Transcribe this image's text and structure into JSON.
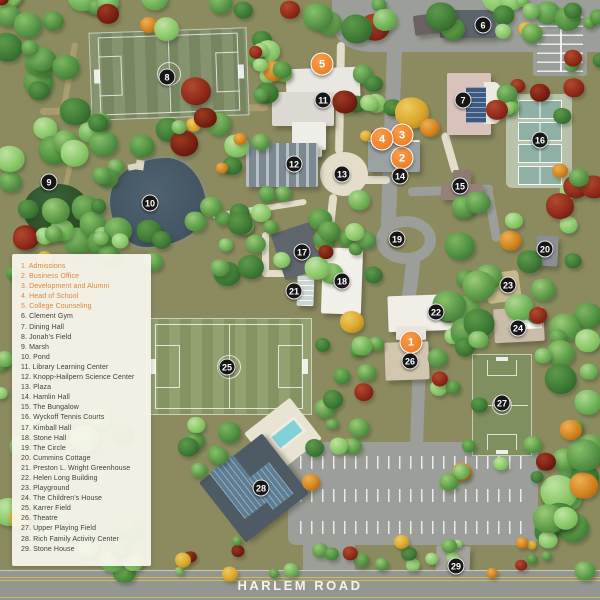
{
  "legend": {
    "items": [
      {
        "num": "1",
        "label": "Admissions",
        "highlighted": true
      },
      {
        "num": "2",
        "label": "Business Office",
        "highlighted": true
      },
      {
        "num": "3",
        "label": "Development and Alumni",
        "highlighted": true
      },
      {
        "num": "4",
        "label": "Head of School",
        "highlighted": true
      },
      {
        "num": "5",
        "label": "College Counseling",
        "highlighted": true
      },
      {
        "num": "6",
        "label": "Clement Gym",
        "highlighted": false
      },
      {
        "num": "7",
        "label": "Dining Hall",
        "highlighted": false
      },
      {
        "num": "8",
        "label": "Jonah's Field",
        "highlighted": false
      },
      {
        "num": "9",
        "label": "Marsh",
        "highlighted": false
      },
      {
        "num": "10",
        "label": "Pond",
        "highlighted": false
      },
      {
        "num": "11",
        "label": "Library Learning Center",
        "highlighted": false
      },
      {
        "num": "12",
        "label": "Knopp-Hailpern Science Center",
        "highlighted": false
      },
      {
        "num": "13",
        "label": "Plaza",
        "highlighted": false
      },
      {
        "num": "14",
        "label": "Hamlin Hall",
        "highlighted": false
      },
      {
        "num": "15",
        "label": "The Bungalow",
        "highlighted": false
      },
      {
        "num": "16",
        "label": "Wyckoff Tennis Courts",
        "highlighted": false
      },
      {
        "num": "17",
        "label": "Kimball Hall",
        "highlighted": false
      },
      {
        "num": "18",
        "label": "Stone Hall",
        "highlighted": false
      },
      {
        "num": "19",
        "label": "The Circle",
        "highlighted": false
      },
      {
        "num": "20",
        "label": "Cummins Cottage",
        "highlighted": false
      },
      {
        "num": "21",
        "label": "Preston L. Wright Greenhouse",
        "highlighted": false
      },
      {
        "num": "22",
        "label": "Helen Long Building",
        "highlighted": false
      },
      {
        "num": "23",
        "label": "Playground",
        "highlighted": false
      },
      {
        "num": "24",
        "label": "The Children's House",
        "highlighted": false
      },
      {
        "num": "25",
        "label": "Karrer Field",
        "highlighted": false
      },
      {
        "num": "26",
        "label": "Theatre",
        "highlighted": false
      },
      {
        "num": "27",
        "label": "Upper Playing Field",
        "highlighted": false
      },
      {
        "num": "28",
        "label": "Rich Family Activity Center",
        "highlighted": false
      },
      {
        "num": "29",
        "label": "Stone House",
        "highlighted": false
      }
    ]
  },
  "road": {
    "label": "HARLEM ROAD"
  },
  "map": {
    "markers": [
      {
        "num": "1",
        "x": 411,
        "y": 342,
        "type": "primary"
      },
      {
        "num": "2",
        "x": 402,
        "y": 158,
        "type": "primary"
      },
      {
        "num": "3",
        "x": 402,
        "y": 135,
        "type": "primary"
      },
      {
        "num": "4",
        "x": 382,
        "y": 139,
        "type": "primary"
      },
      {
        "num": "5",
        "x": 322,
        "y": 64,
        "type": "primary"
      },
      {
        "num": "6",
        "x": 483,
        "y": 25,
        "type": "secondary"
      },
      {
        "num": "7",
        "x": 463,
        "y": 100,
        "type": "secondary"
      },
      {
        "num": "8",
        "x": 167,
        "y": 77,
        "type": "secondary"
      },
      {
        "num": "9",
        "x": 49,
        "y": 182,
        "type": "secondary"
      },
      {
        "num": "10",
        "x": 150,
        "y": 203,
        "type": "secondary"
      },
      {
        "num": "11",
        "x": 323,
        "y": 100,
        "type": "secondary"
      },
      {
        "num": "12",
        "x": 294,
        "y": 164,
        "type": "secondary"
      },
      {
        "num": "13",
        "x": 342,
        "y": 174,
        "type": "secondary"
      },
      {
        "num": "14",
        "x": 400,
        "y": 176,
        "type": "secondary"
      },
      {
        "num": "15",
        "x": 460,
        "y": 186,
        "type": "secondary"
      },
      {
        "num": "16",
        "x": 540,
        "y": 140,
        "type": "secondary"
      },
      {
        "num": "17",
        "x": 302,
        "y": 252,
        "type": "secondary"
      },
      {
        "num": "18",
        "x": 342,
        "y": 281,
        "type": "secondary"
      },
      {
        "num": "19",
        "x": 397,
        "y": 239,
        "type": "secondary"
      },
      {
        "num": "20",
        "x": 545,
        "y": 249,
        "type": "secondary"
      },
      {
        "num": "21",
        "x": 294,
        "y": 291,
        "type": "secondary"
      },
      {
        "num": "22",
        "x": 436,
        "y": 312,
        "type": "secondary"
      },
      {
        "num": "23",
        "x": 508,
        "y": 285,
        "type": "secondary"
      },
      {
        "num": "24",
        "x": 518,
        "y": 328,
        "type": "secondary"
      },
      {
        "num": "25",
        "x": 227,
        "y": 367,
        "type": "secondary"
      },
      {
        "num": "26",
        "x": 410,
        "y": 361,
        "type": "secondary"
      },
      {
        "num": "27",
        "x": 502,
        "y": 403,
        "type": "secondary"
      },
      {
        "num": "28",
        "x": 261,
        "y": 488,
        "type": "secondary"
      },
      {
        "num": "29",
        "x": 456,
        "y": 566,
        "type": "secondary"
      }
    ]
  },
  "colors": {
    "highlight_orange": "#ee8129",
    "marker_dark": "#161616",
    "legend_text": "#3e3e3e",
    "legend_highlight_text": "#e0853c",
    "legend_bg": "#faf7ee",
    "map_base": "#8c8b60",
    "pond_water": "#445664",
    "road_gray": "#9c9e99",
    "road_line_yellow": "#d3bc4f"
  }
}
